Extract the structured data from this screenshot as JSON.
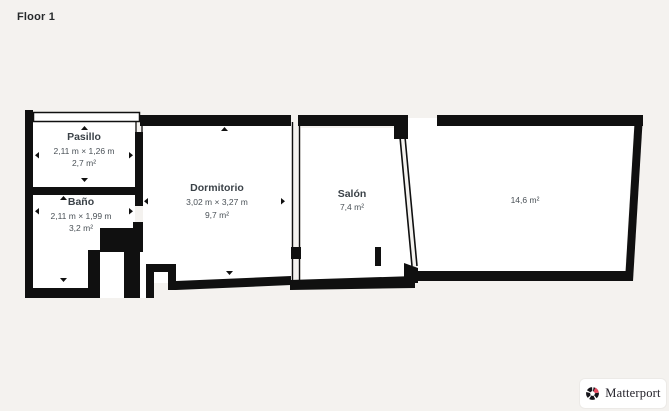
{
  "page": {
    "title": "Floor 1",
    "background_color": "#f4f2ef",
    "wall_color": "#101010",
    "floor_color": "#ffffff",
    "label_color": "#3b4248"
  },
  "floorplan": {
    "rooms": [
      {
        "id": "pasillo",
        "name": "Pasillo",
        "dimensions": "2,11 m × 1,26 m",
        "area": "2,7 m²"
      },
      {
        "id": "bano",
        "name": "Baño",
        "dimensions": "2,11 m × 1,99 m",
        "area": "3,2 m²"
      },
      {
        "id": "dormitorio",
        "name": "Dormitorio",
        "dimensions": "3,02 m × 3,27 m",
        "area": "9,7 m²"
      },
      {
        "id": "salon",
        "name": "Salón",
        "dimensions": "",
        "area": "7,4 m²"
      },
      {
        "id": "room-5",
        "name": "",
        "dimensions": "",
        "area": "14,6 m²"
      }
    ]
  },
  "branding": {
    "logo_text": "Matterport",
    "accent_color": "#e8485e"
  }
}
